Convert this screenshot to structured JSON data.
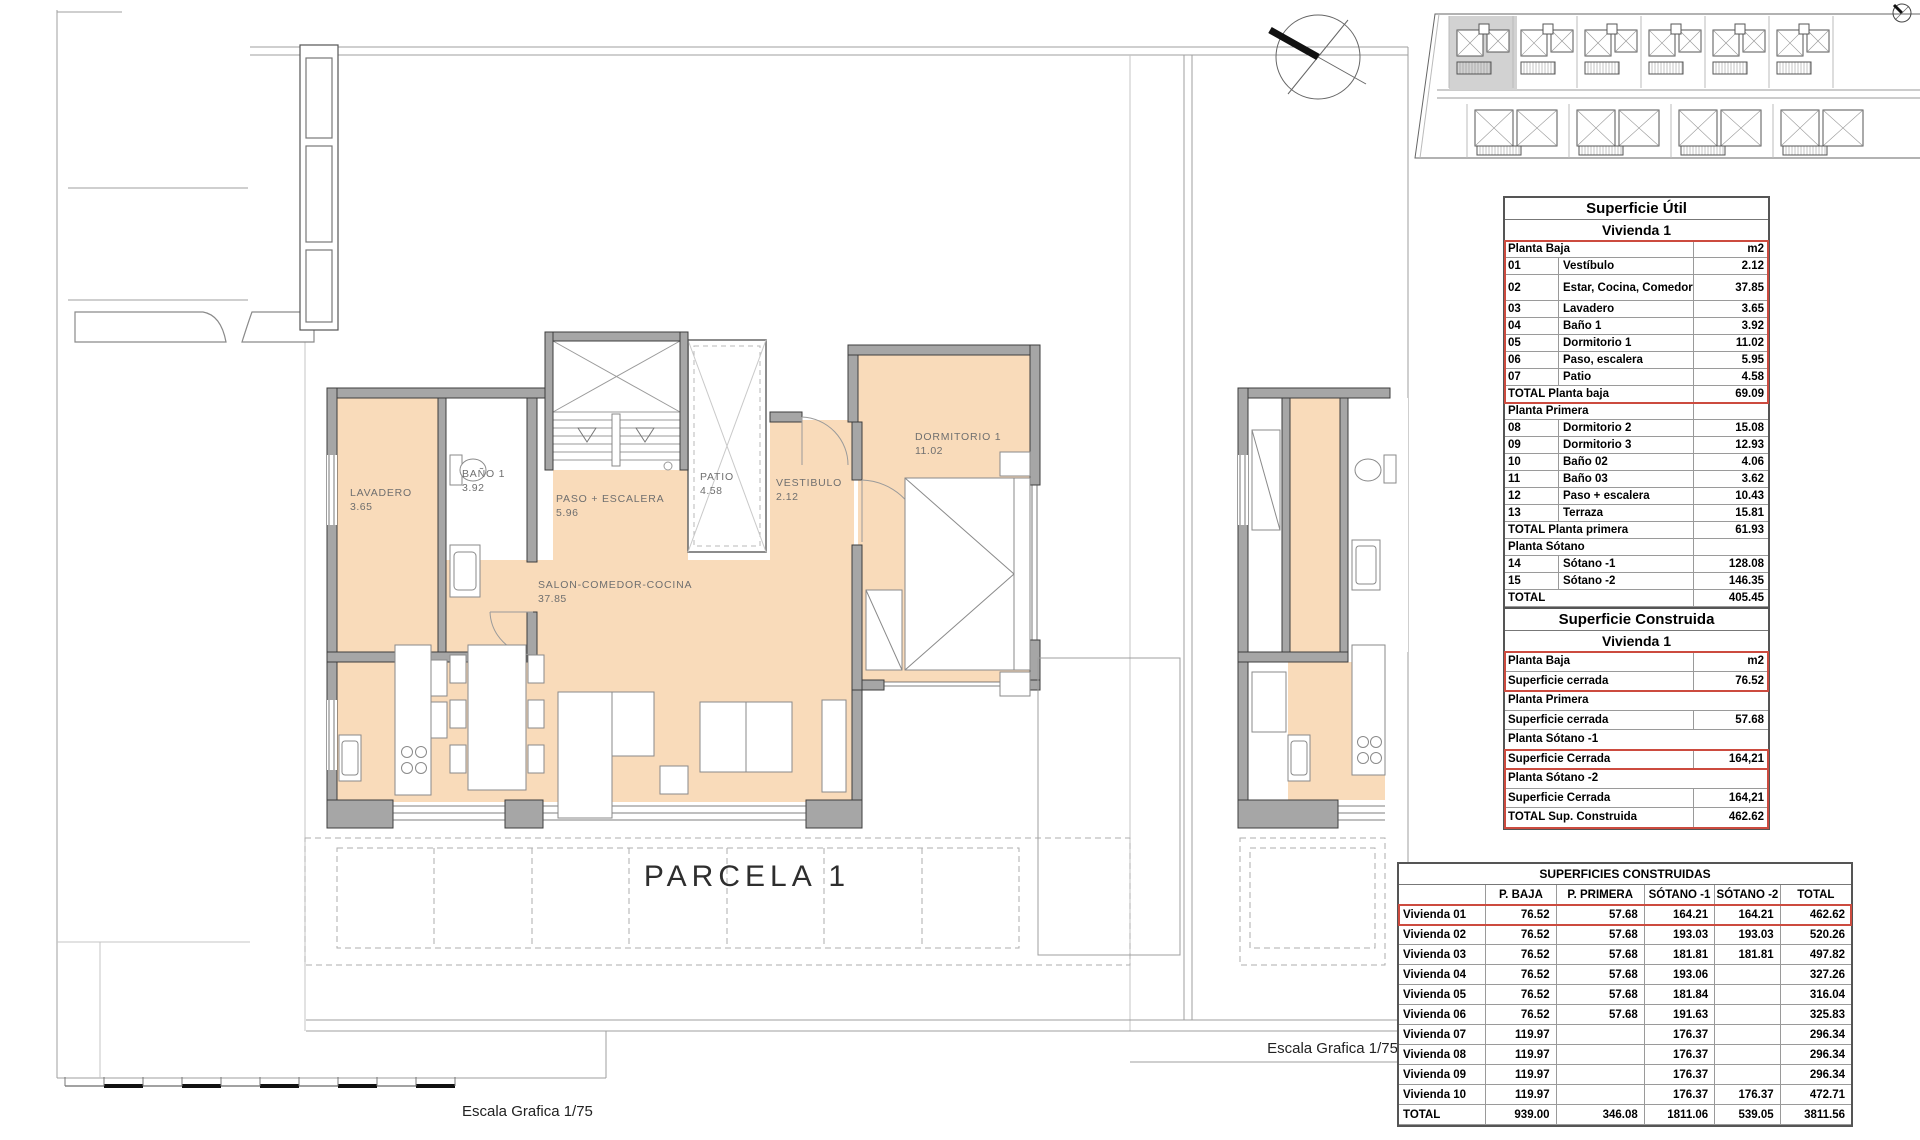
{
  "plan": {
    "labels": {
      "lavadero": {
        "name": "LAVADERO",
        "value": "3.65"
      },
      "bano": {
        "name": "BAÑO 1",
        "value": "3.92"
      },
      "paso": {
        "name": "PASO + ESCALERA",
        "value": "5.96"
      },
      "patio": {
        "name": "PATIO",
        "value": "4.58"
      },
      "vestibulo": {
        "name": "VESTIBULO",
        "value": "2.12"
      },
      "dormitorio": {
        "name": "DORMITORIO 1",
        "value": "11.02"
      },
      "salon": {
        "name": "SALON-COMEDOR-COCINA",
        "value": "37.85"
      }
    },
    "parcela_label": "PARCELA 1",
    "scale_label_bottom": "Escala Grafica 1/75",
    "scale_label_right": "Escala Grafica 1/75",
    "colors": {
      "floor": "#f9dbba",
      "wall": "#a6a6a6",
      "wall_stroke": "#3d3d3d",
      "accent_red": "#cc4b3f"
    }
  },
  "site_plan": {
    "top_units": 6,
    "bottom_units": 4,
    "highlighted_unit": 1
  },
  "tables": {
    "util": {
      "title": "Superficie Útil",
      "subtitle": "Vivienda 1",
      "sections": [
        {
          "header": "Planta Baja",
          "unit": "m2",
          "red": true,
          "rows": [
            [
              "01",
              "Vestíbulo",
              "2.12",
              0
            ],
            [
              "02",
              "Estar, Cocina, Comedor",
              "37.85",
              1
            ],
            [
              "03",
              "Lavadero",
              "3.65",
              0
            ],
            [
              "04",
              "Baño 1",
              "3.92",
              0
            ],
            [
              "05",
              "Dormitorio 1",
              "11.02",
              0
            ],
            [
              "06",
              "Paso, escalera",
              "5.95",
              0
            ],
            [
              "07",
              "Patio",
              "4.58",
              0
            ]
          ],
          "total": [
            "TOTAL Planta baja",
            "69.09"
          ]
        },
        {
          "header": "Planta Primera",
          "unit": "",
          "red": false,
          "rows": [
            [
              "08",
              "Dormitorio 2",
              "15.08",
              0
            ],
            [
              "09",
              "Dormitorio 3",
              "12.93",
              0
            ],
            [
              "10",
              "Baño 02",
              "4.06",
              0
            ],
            [
              "11",
              "Baño 03",
              "3.62",
              0
            ],
            [
              "12",
              "Paso + escalera",
              "10.43",
              0
            ],
            [
              "13",
              "Terraza",
              "15.81",
              0
            ]
          ],
          "total": [
            "TOTAL Planta primera",
            "61.93"
          ]
        },
        {
          "header": "Planta Sótano",
          "unit": "",
          "red": false,
          "rows": [
            [
              "14",
              "Sótano -1",
              "128.08",
              0
            ],
            [
              "15",
              "Sótano -2",
              "146.35",
              0
            ]
          ],
          "total": [
            "TOTAL",
            "405.45"
          ]
        }
      ]
    },
    "construida": {
      "title": "Superficie Construida",
      "subtitle": "Vivienda 1",
      "groups": [
        {
          "red": true,
          "rows": [
            {
              "l": "Planta Baja",
              "v": "m2",
              "h": 1
            },
            {
              "l": "Superficie cerrada",
              "v": "76.52",
              "h": 0
            }
          ]
        },
        {
          "red": false,
          "rows": [
            {
              "l": "Planta Primera",
              "v": "",
              "h": 1
            },
            {
              "l": "Superficie cerrada",
              "v": "57.68",
              "h": 0
            }
          ]
        },
        {
          "red": false,
          "rows": [
            {
              "l": "Planta Sótano -1",
              "v": "",
              "h": 1
            }
          ]
        },
        {
          "red": true,
          "rows": [
            {
              "l": "Superficie Cerrada",
              "v": "164,21",
              "h": 0
            }
          ]
        },
        {
          "red": true,
          "rows": [
            {
              "l": "Planta Sótano -2",
              "v": "",
              "h": 1
            },
            {
              "l": "Superficie Cerrada",
              "v": "164,21",
              "h": 0
            },
            {
              "l": "TOTAL Sup. Construida",
              "v": "462.62",
              "h": 0
            }
          ]
        }
      ]
    },
    "resumen": {
      "title": "SUPERFICIES CONSTRUIDAS",
      "columns": [
        "",
        "P. BAJA",
        "P. PRIMERA",
        "SÓTANO -1",
        "SÓTANO -2",
        "TOTAL"
      ],
      "col_widths": [
        88,
        71,
        89,
        71,
        66,
        71
      ],
      "rows": [
        {
          "name": "Vivienda 01",
          "values": [
            "76.52",
            "57.68",
            "164.21",
            "164.21",
            "462.62"
          ],
          "red": true
        },
        {
          "name": "Vivienda 02",
          "values": [
            "76.52",
            "57.68",
            "193.03",
            "193.03",
            "520.26"
          ],
          "red": false
        },
        {
          "name": "Vivienda 03",
          "values": [
            "76.52",
            "57.68",
            "181.81",
            "181.81",
            "497.82"
          ],
          "red": false
        },
        {
          "name": "Vivienda 04",
          "values": [
            "76.52",
            "57.68",
            "193.06",
            "",
            "327.26"
          ],
          "red": false
        },
        {
          "name": "Vivienda 05",
          "values": [
            "76.52",
            "57.68",
            "181.84",
            "",
            "316.04"
          ],
          "red": false
        },
        {
          "name": "Vivienda 06",
          "values": [
            "76.52",
            "57.68",
            "191.63",
            "",
            "325.83"
          ],
          "red": false
        },
        {
          "name": "Vivienda 07",
          "values": [
            "119.97",
            "",
            "176.37",
            "",
            "296.34"
          ],
          "red": false
        },
        {
          "name": "Vivienda 08",
          "values": [
            "119.97",
            "",
            "176.37",
            "",
            "296.34"
          ],
          "red": false
        },
        {
          "name": "Vivienda 09",
          "values": [
            "119.97",
            "",
            "176.37",
            "",
            "296.34"
          ],
          "red": false
        },
        {
          "name": "Vivienda 10",
          "values": [
            "119.97",
            "",
            "176.37",
            "176.37",
            "472.71"
          ],
          "red": false
        },
        {
          "name": "TOTAL",
          "values": [
            "939.00",
            "346.08",
            "1811.06",
            "539.05",
            "3811.56"
          ],
          "red": false
        }
      ]
    }
  }
}
